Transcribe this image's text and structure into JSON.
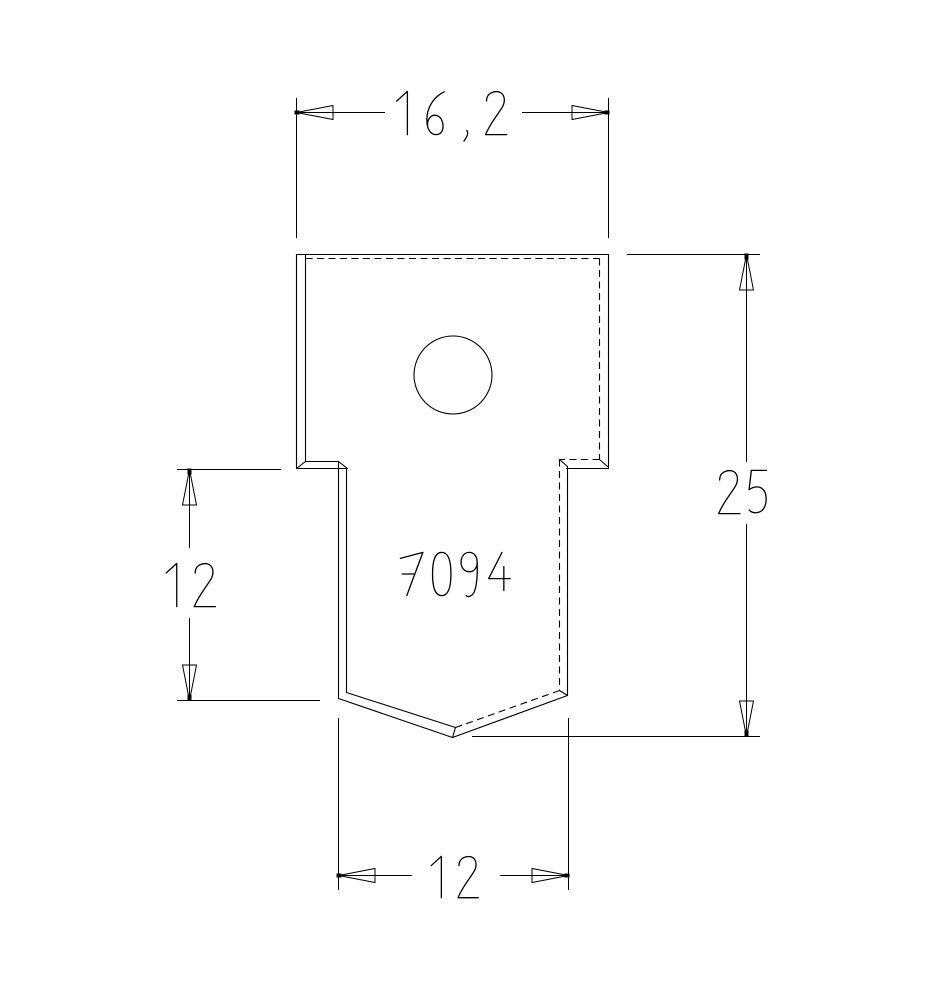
{
  "drawing": {
    "background_color": "#ffffff",
    "line_color": "#000000",
    "part": {
      "number": "7094"
    },
    "dimensions": {
      "top_width": "16 , 2",
      "overall_height": "25",
      "tab_length": "12",
      "tab_width": "12"
    }
  }
}
